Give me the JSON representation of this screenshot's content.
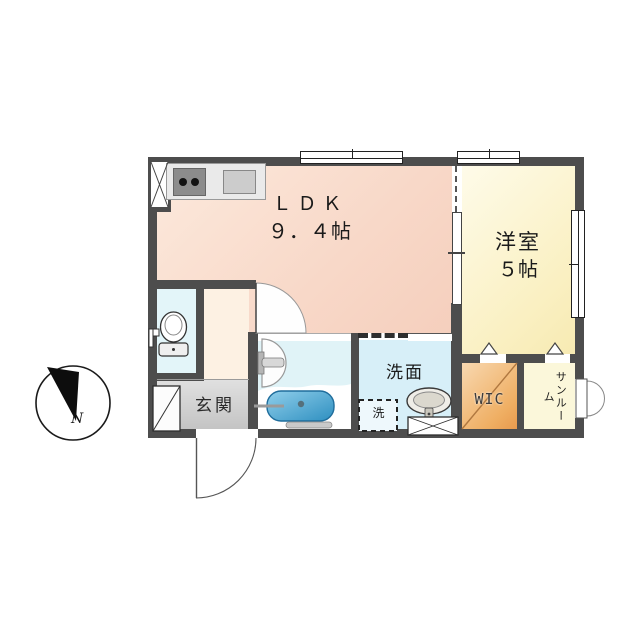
{
  "plan_type": "apartment-floor-plan",
  "rooms": {
    "ldk": {
      "label": "ＬＤＫ",
      "size": "９．４帖"
    },
    "bedroom": {
      "label": "洋室",
      "size": "５帖"
    },
    "washroom": {
      "label": "洗面"
    },
    "washer_space": {
      "label": "洗"
    },
    "wic": {
      "label": "WIC"
    },
    "sunroom": {
      "label": "サンルーム"
    },
    "entrance": {
      "label": "玄関"
    }
  },
  "compass": {
    "north_label": "N"
  },
  "colors": {
    "wall": "#4d4d4d",
    "ldk_floor": "#f8d8c8",
    "bedroom_floor": "#faf0c2",
    "hall_floor": "#fdf1e3",
    "toilet_floor": "#e3f5f9",
    "bath_floor": "#e0f3f7",
    "washroom_floor": "#d7eff8",
    "wic_floor": "#efae62",
    "sunroom_floor": "#fbf7da",
    "entrance_floor": "#cfcfcf",
    "tub_water": "#3e9dcd"
  },
  "icons": {
    "compass": "north-arrow-icon",
    "stove": "stove-burners-icon",
    "kitchen_sink": "kitchen-sink-icon",
    "toilet": "toilet-icon",
    "bathtub": "bathtub-icon",
    "shower": "shower-mixer-icon",
    "washbasin": "washbasin-icon",
    "shoe_cabinet": "shoe-cabinet-icon",
    "washer": "washing-machine-space-icon"
  }
}
